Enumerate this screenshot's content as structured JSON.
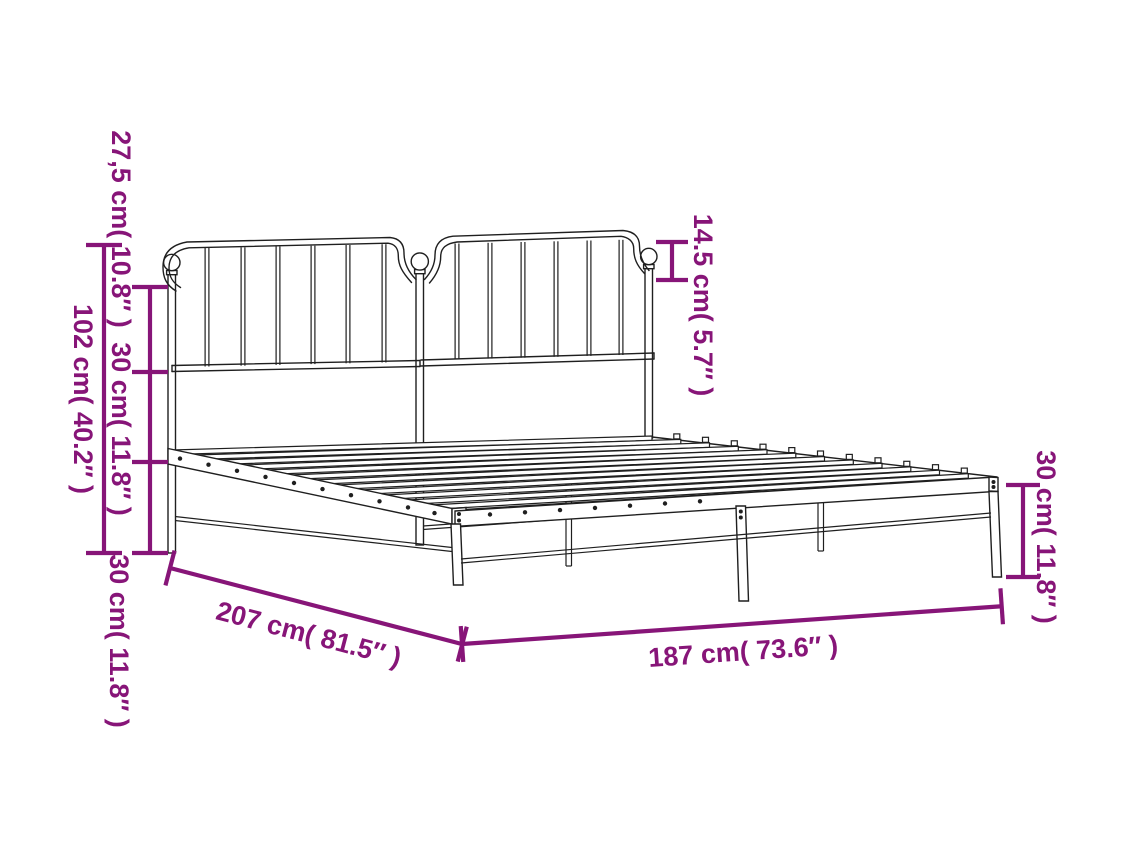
{
  "diagram": {
    "title": "Metal bed frame with headboard — dimension diagram",
    "accent_color": "#871578",
    "line_color": "#1f1f1f",
    "background_color": "#ffffff",
    "measurements": {
      "total_height": {
        "cm": "102",
        "in": "40.2",
        "text": "102 cm( 40.2″ )"
      },
      "headboard_upper_section": {
        "cm": "27,5",
        "in": "10.8",
        "text": "27,5 cm( 10.8″ )"
      },
      "headboard_middle_section": {
        "cm": "30",
        "in": "11.8",
        "text": "30 cm( 11.8″ )"
      },
      "headboard_lower_section": {
        "cm": "30",
        "in": "11.8",
        "text": "30 cm( 11.8″ )"
      },
      "finial_height": {
        "cm": "14.5",
        "in": "5.7",
        "text": "14.5 cm( 5.7″ )"
      },
      "leg_height": {
        "cm": "30",
        "in": "11.8",
        "text": "30 cm( 11.8″ )"
      },
      "frame_length": {
        "cm": "207",
        "in": "81.5",
        "text": "207 cm( 81.5″ )"
      },
      "frame_width": {
        "cm": "187",
        "in": "73.6",
        "text": "187 cm( 73.6″ )"
      }
    }
  }
}
